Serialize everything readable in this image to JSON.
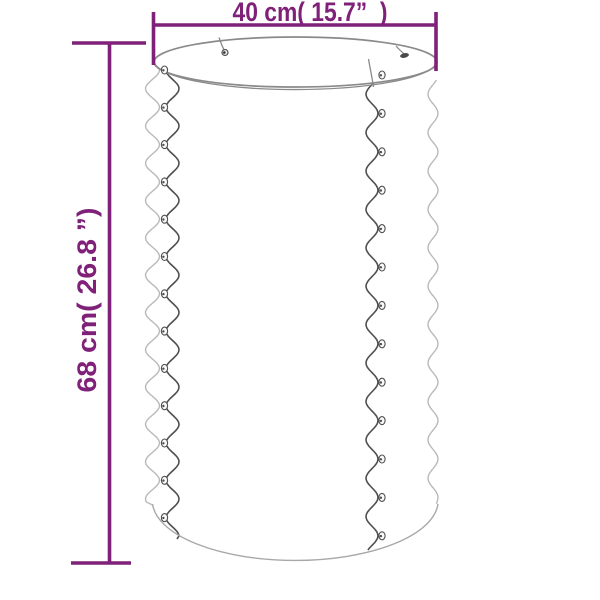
{
  "dimensions": {
    "width": {
      "label": "40 cm( 15.7”  )"
    },
    "height": {
      "label": "68 cm( 26.8 ”)"
    }
  },
  "colors": {
    "accent": "#7f2079",
    "stroke_dark": "#4f4f4f",
    "stroke_mid": "#8a8a8a",
    "stroke_light": "#b9b9b9",
    "stroke_arc": "#a8a8a8",
    "background": "#ffffff"
  },
  "drawing": {
    "left_seam_rivet_count": 13,
    "right_seam_rivet_count": 13,
    "rim_rivet_count": 2
  }
}
